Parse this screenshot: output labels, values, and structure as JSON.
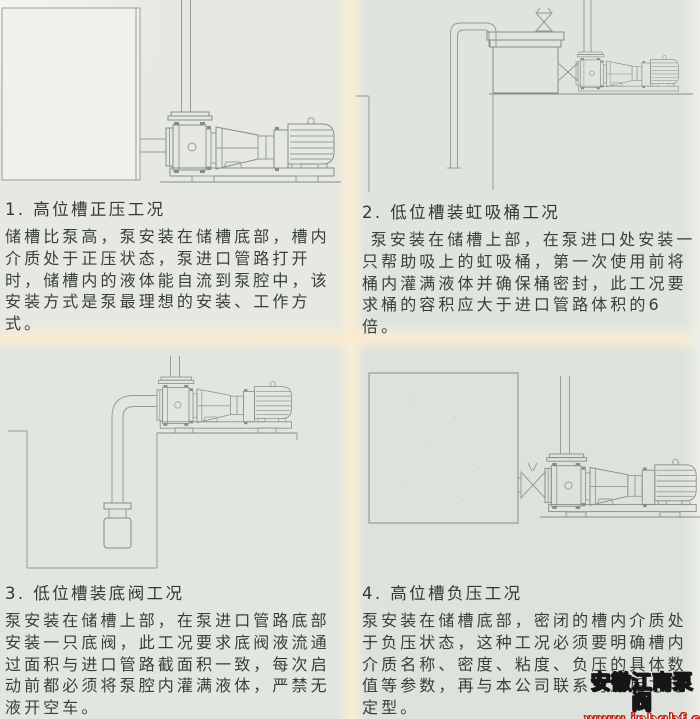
{
  "panels": [
    {
      "heading": "1. 高位槽正压工况",
      "body": "储槽比泵高，泵安装在储槽底部，槽内介质处于正压状态，泵进口管路打开时，储槽内的液体能自流到泵腔中，该安装方式是泵最理想的安装、工作方式。"
    },
    {
      "heading": "2. 低位槽装虹吸桶工况",
      "body": "泵安装在储槽上部，在泵进口处安装一只帮助吸上的虹吸桶，第一次使用前将桶内灌满液体并确保桶密封，此工况要求桶的容积应大于进口管路体积的6倍。"
    },
    {
      "heading": "3. 低位槽装底阀工况",
      "body": "泵安装在储槽上部，在泵进口管路底部安装一只底阀，此工况要求底阀液流通过面积与进口管路截面积一致，每次启动前都必须将泵腔内灌满液体，严禁无液开空车。"
    },
    {
      "heading": "4. 高位槽负压工况",
      "body": "泵安装在储槽底部，密闭的槽内介质处于负压状态，这种工况必须要明确槽内介质名称、密度、粘度、负压的具体数值等参数，再与本公司联系沟通后方可定型。"
    }
  ],
  "watermark": {
    "brand": "安徽江南泵阀",
    "url": "www.jnhgbf.com"
  },
  "colors": {
    "paper": "#e1e5e0",
    "fold_band": "#f8ecd5",
    "ink": "#3b3f3b",
    "drawing_line": "#979d95",
    "watermark_brand_outline": "#161616",
    "watermark_url_outline": "#c0251a"
  }
}
